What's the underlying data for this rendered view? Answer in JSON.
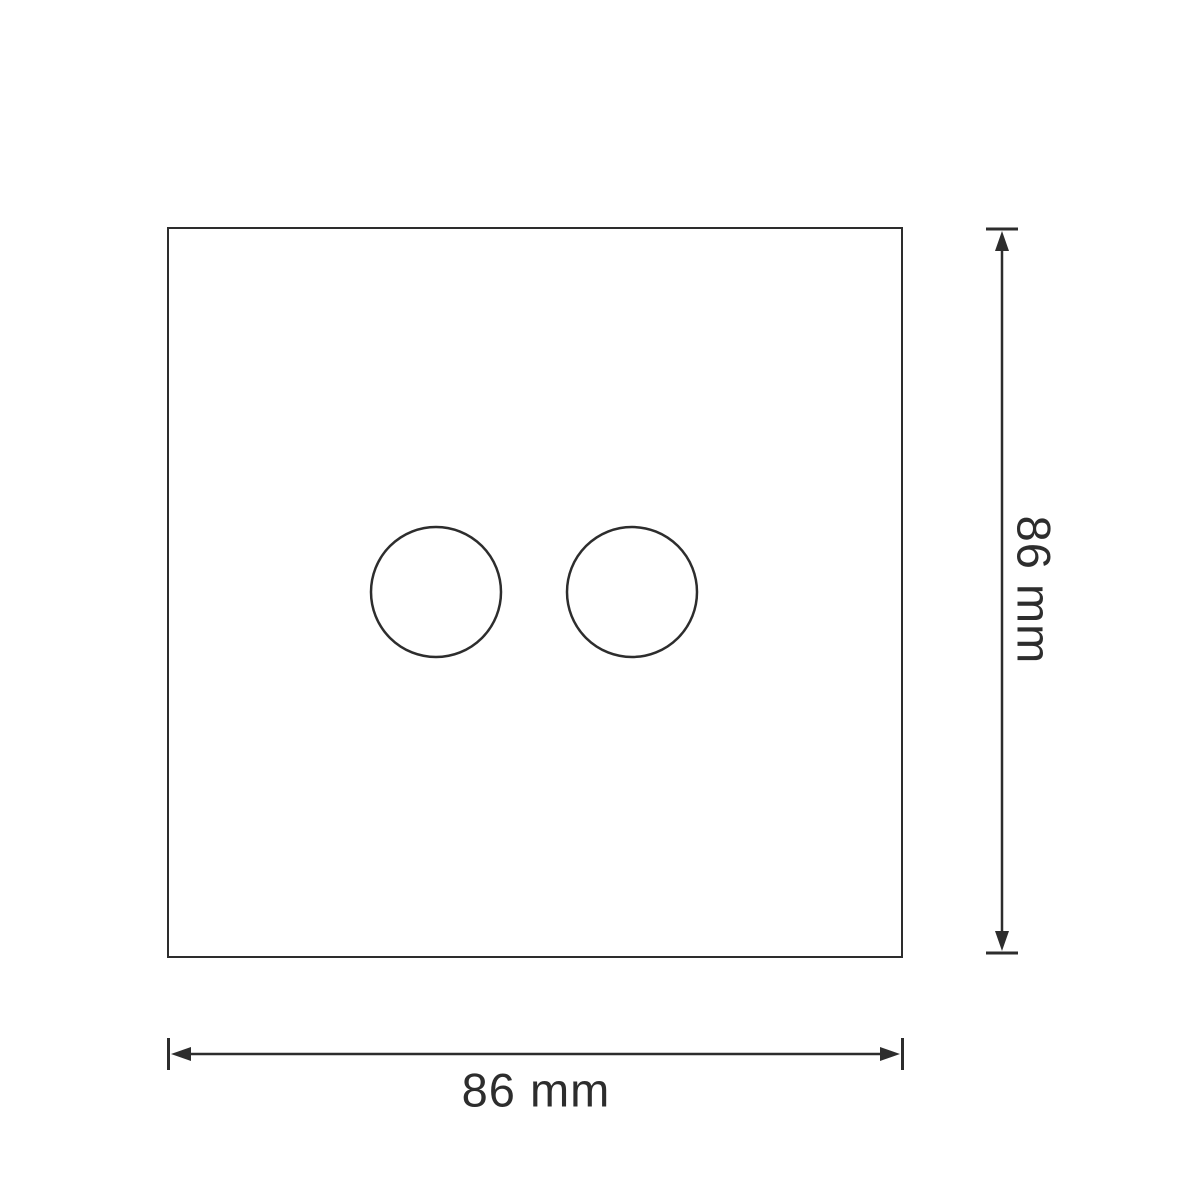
{
  "drawing": {
    "kind": "technical-dimension-diagram",
    "dimensions": {
      "width": {
        "label": "86 mm",
        "value": 86,
        "unit": "mm"
      },
      "height": {
        "label": "86 mm",
        "value": 86,
        "unit": "mm"
      }
    },
    "shape_counts": {
      "plate_outline": 1,
      "circular_cutouts": 2
    }
  },
  "colors": {
    "background": "#ffffff",
    "line": "#2d2d2d",
    "text": "#2d2d2d"
  }
}
